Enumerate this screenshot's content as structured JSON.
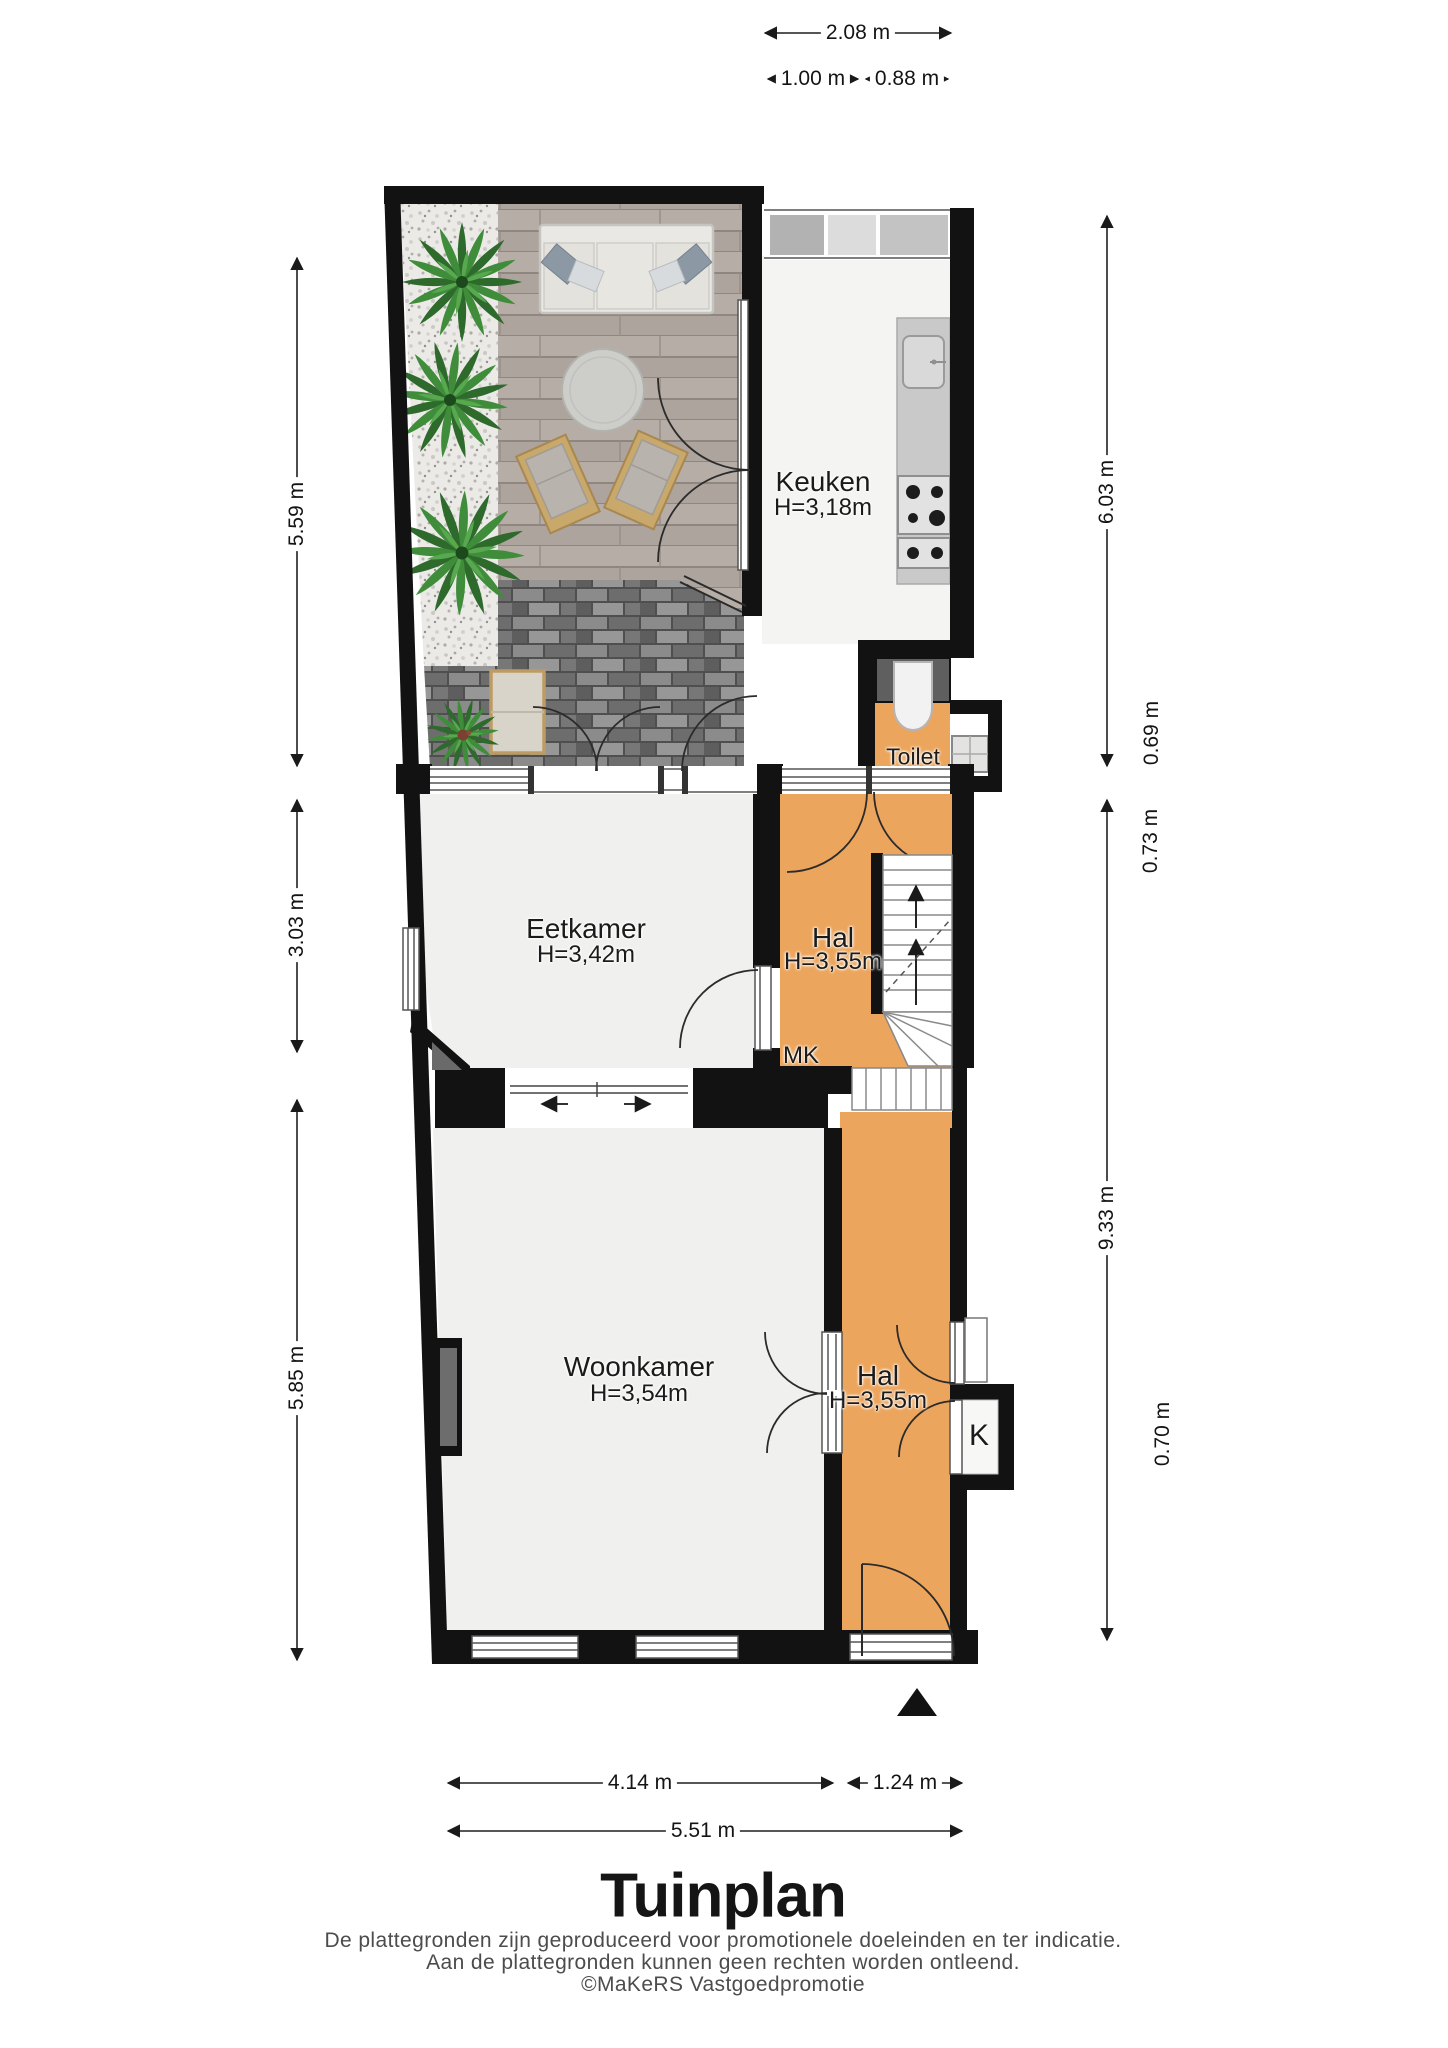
{
  "plan": {
    "title": "Tuinplan",
    "disclaimer_line1": "De plattegronden zijn geproduceerd voor promotionele doeleinden en ter indicatie.",
    "disclaimer_line2": "Aan de plattegronden kunnen geen rechten worden ontleend.",
    "credit": "©MaKeRS Vastgoedpromotie"
  },
  "rooms": {
    "keuken": {
      "name": "Keuken",
      "height": "H=3,18m"
    },
    "toilet": {
      "name": "Toilet"
    },
    "eetkamer": {
      "name": "Eetkamer",
      "height": "H=3,42m"
    },
    "hal_boven": {
      "name": "Hal",
      "height": "H=3,55m"
    },
    "meterkast": {
      "label": "MK"
    },
    "woonkamer": {
      "name": "Woonkamer",
      "height": "H=3,54m"
    },
    "hal_beneden": {
      "name": "Hal",
      "height": "H=3,55m"
    },
    "kast": {
      "label": "K"
    }
  },
  "dimensions": {
    "top_total": "2.08 m",
    "top_left": "1.00 m",
    "top_right": "0.88 m",
    "left_garden": "5.59 m",
    "left_eetkamer": "3.03 m",
    "left_woonkamer": "5.85 m",
    "right_keuken": "6.03 m",
    "right_toilet": "0.69 m",
    "right_hal_entry": "0.73 m",
    "right_rear": "9.33 m",
    "right_kast": "0.70 m",
    "bottom_woonkamer": "4.14 m",
    "bottom_hal": "1.24 m",
    "bottom_total": "5.51 m"
  },
  "colors": {
    "wall": "#121212",
    "hall_orange": "#eca55c",
    "room_floor": "#f0f0ef",
    "deck": "#b3aaa3",
    "paving": "#6f6f6f",
    "plant_green": "#3c8338"
  }
}
